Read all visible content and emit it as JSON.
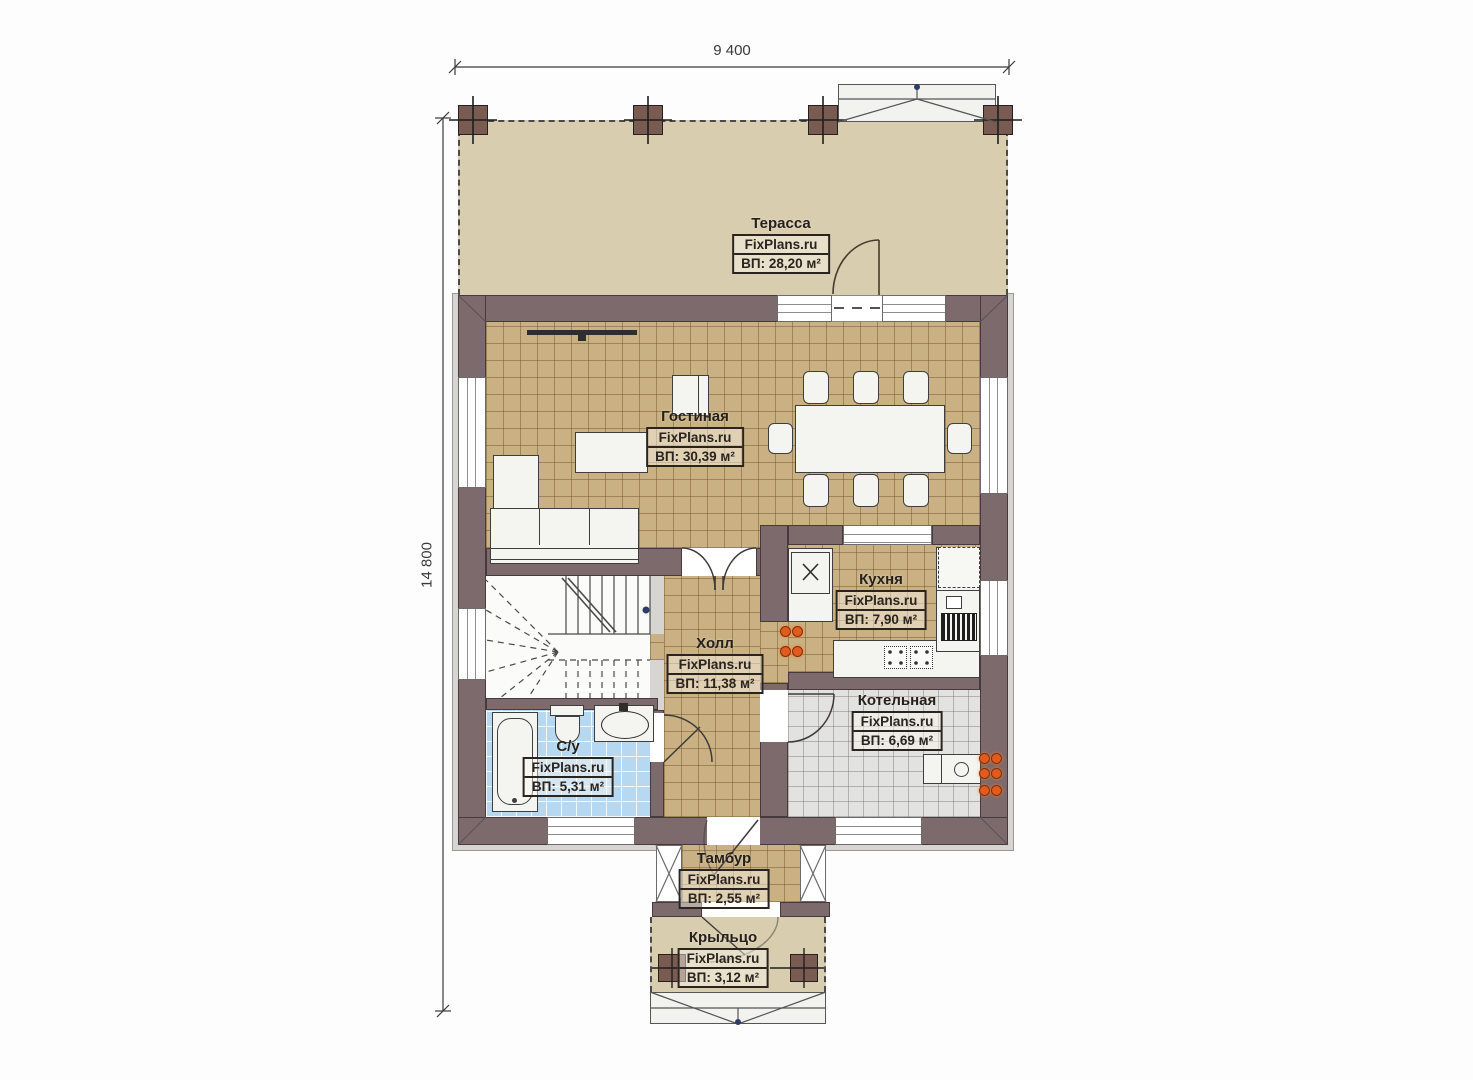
{
  "watermark": "FixPlans.ru",
  "dimensions": {
    "width": "9 400",
    "height": "14 800"
  },
  "rooms": [
    {
      "id": "terrace",
      "name": "Терасса",
      "area": "ВП: 28,20 м²"
    },
    {
      "id": "living",
      "name": "Гостиная",
      "area": "ВП: 30,39 м²"
    },
    {
      "id": "kitchen",
      "name": "Кухня",
      "area": "ВП: 7,90 м²"
    },
    {
      "id": "hall",
      "name": "Холл",
      "area": "ВП: 11,38 м²"
    },
    {
      "id": "boiler",
      "name": "Котельная",
      "area": "ВП: 6,69 м²"
    },
    {
      "id": "bathroom",
      "name": "С/у",
      "area": "ВП: 5,31 м²"
    },
    {
      "id": "vestibule",
      "name": "Тамбур",
      "area": "ВП: 2,55 м²"
    },
    {
      "id": "porch",
      "name": "Крыльцо",
      "area": "ВП: 3,12 м²"
    }
  ],
  "colors": {
    "wall": "#7d6a6c",
    "floor_tile": "#c9b183",
    "terrace_floor": "#d9cdb0",
    "bathroom_floor": "#b6d8f1",
    "boiler_floor": "#e2e2e0",
    "column": "#7a5b52",
    "utility_marker": "#e25a1d"
  }
}
